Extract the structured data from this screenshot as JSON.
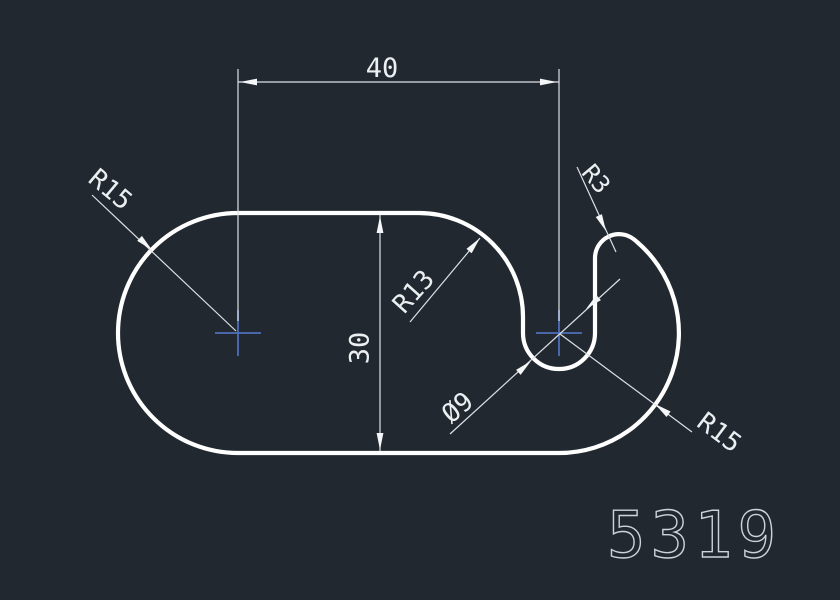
{
  "drawing": {
    "part_number": "5319",
    "dimensions": {
      "top_width": "40",
      "height": "30",
      "left_radius": "R15",
      "inner_radius": "R13",
      "slot_diameter": "Ø9",
      "hook_radius": "R3",
      "right_radius": "R15"
    },
    "colors": {
      "background": "#212830",
      "outline": "#ffffff",
      "dimension": "#eceff1",
      "center_mark": "#4e6fba",
      "part_number_color": "#ccd3d9"
    }
  }
}
